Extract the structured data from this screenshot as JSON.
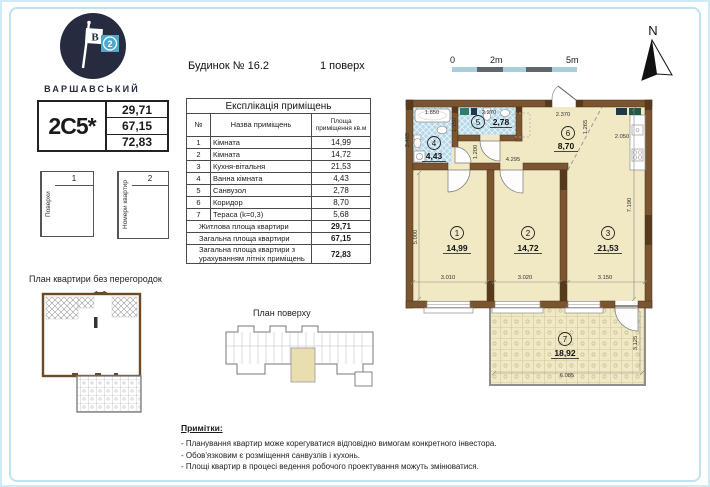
{
  "logo": {
    "brand": "ВАРШАВСЬКИЙ",
    "flag_b": "B",
    "flag_2": "2"
  },
  "header": {
    "building": "Будинок № 16.2",
    "floor": "1 поверх"
  },
  "apartment_card": {
    "code": "2C5*",
    "living_area": "29,71",
    "total_area": "67,15",
    "total_with_summer": "72,83"
  },
  "floors_card": {
    "label": "Поверхи",
    "value": "1"
  },
  "numbers_card": {
    "label": "Номери квартир",
    "value": "2"
  },
  "explication": {
    "title": "Експлікація приміщень",
    "col_num": "№",
    "col_name": "Назва приміщень",
    "col_area": "Площа приміщення кв.м",
    "rows": [
      {
        "num": "1",
        "name": "Кімната",
        "area": "14,99"
      },
      {
        "num": "2",
        "name": "Кімната",
        "area": "14,72"
      },
      {
        "num": "3",
        "name": "Кухня-вітальня",
        "area": "21,53"
      },
      {
        "num": "4",
        "name": "Ванна кімната",
        "area": "4,43"
      },
      {
        "num": "5",
        "name": "Санвузол",
        "area": "2,78"
      },
      {
        "num": "6",
        "name": "Коридор",
        "area": "8,70"
      },
      {
        "num": "7",
        "name": "Тераса (k=0,3)",
        "area": "5,68"
      }
    ],
    "summary": [
      {
        "label": "Житлова площа квартири",
        "value": "29,71"
      },
      {
        "label": "Загальна площа квартири",
        "value": "67,15"
      },
      {
        "label": "Загальна площа квартири з урахуванням літніх приміщень",
        "value": "72,83"
      }
    ]
  },
  "scale_bar": {
    "zero": "0",
    "two": "2m",
    "five": "5m"
  },
  "north_label": "N",
  "plan": {
    "rooms": [
      {
        "num": "1",
        "area": "14,99"
      },
      {
        "num": "2",
        "area": "14,72"
      },
      {
        "num": "3",
        "area": "21,53"
      },
      {
        "num": "4",
        "area": "4,43"
      },
      {
        "num": "5",
        "area": "2,78"
      },
      {
        "num": "6",
        "area": "8,70"
      },
      {
        "num": "7",
        "area": "18,92"
      }
    ],
    "dims": {
      "d1850": "1.850",
      "d2465": "2.465",
      "d1150": "1.150",
      "d2270": "2.270",
      "d2370": "2.370",
      "d1265": "1.265",
      "d2050": "2.050",
      "d1200": "1.200",
      "d4295": "4.295",
      "d5000": "5.000",
      "d7190": "7.190",
      "d3010": "3.010",
      "d3020": "3.020",
      "d3150": "3.150",
      "d6085": "6.085",
      "d3125": "3.125"
    }
  },
  "no_partitions_title": "План квартири без перегородок",
  "floor_plan_title": "План поверху",
  "notes": {
    "title": "Примітки:",
    "items": [
      "- Планування квартир може корегуватися відповідно вимогам конкретного інвестора.",
      "- Обов'язковим є розміщення санвузлів і кухонь.",
      "- Площі квартир в процесі ведення робочого проектування можуть змінюватися."
    ]
  },
  "colors": {
    "accent_blue": "#4fa8cc",
    "wall_brown": "#7b5530",
    "room_beige": "#f0e9c4",
    "tile_blue": "#b5d7e8",
    "navy": "#262b3f",
    "frame_blue": "#bfe3f2"
  }
}
